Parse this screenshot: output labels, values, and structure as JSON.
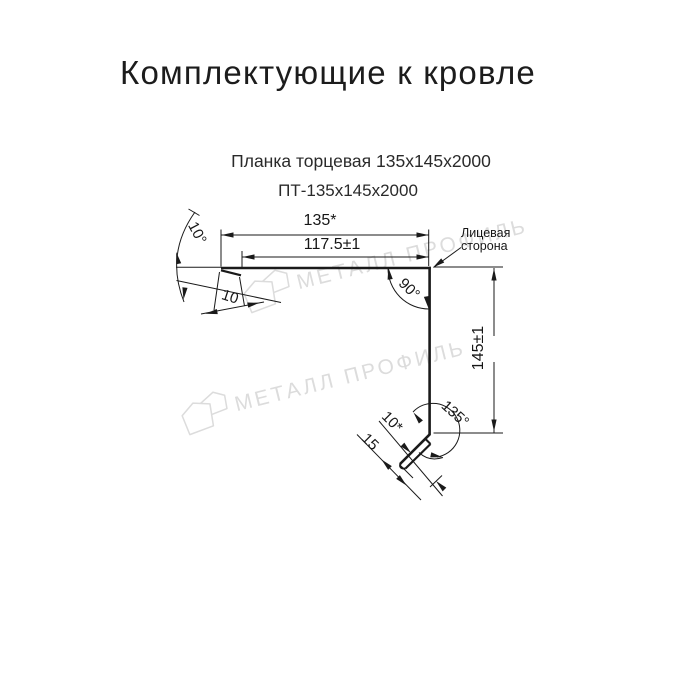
{
  "title": {
    "text": "Комплектующие к кровле"
  },
  "subtitle": {
    "line1": "Планка торцевая 135х145х2000",
    "line2": "ПТ-135х145х2000"
  },
  "drawing": {
    "dimensions": {
      "top_width": "135*",
      "top_inner_width": "117.5±1",
      "side_height": "145±1",
      "flange_bend_angle": "10°",
      "flange_hem_length": "10",
      "corner_angle": "90°",
      "bottom_bend_angle": "135°",
      "bottom_hem_length": "10*",
      "bottom_edge_length": "15"
    },
    "annotations": {
      "face_side_line1": "Лицевая",
      "face_side_line2": "сторона"
    },
    "colors": {
      "line": "#1a1a1a",
      "watermark": "#dcdcdc"
    }
  },
  "watermark": {
    "text": "МЕТАЛЛ ПРОФИЛЬ"
  }
}
